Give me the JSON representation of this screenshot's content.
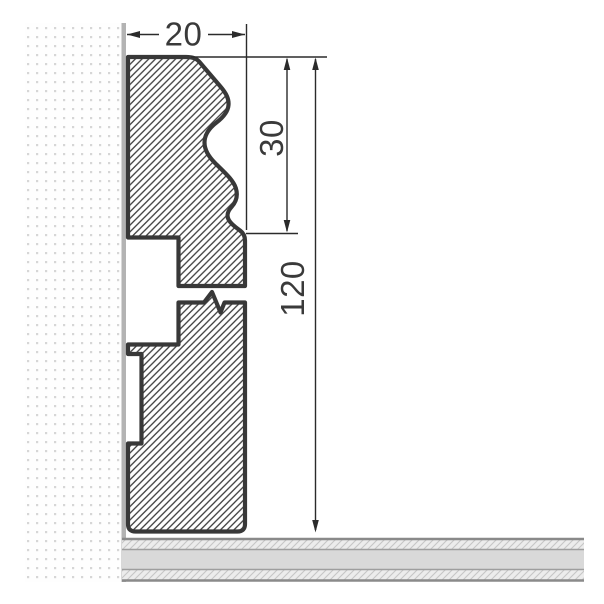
{
  "drawing": {
    "dimensions": {
      "width_label": "20",
      "ogee_height_label": "30",
      "total_height_label": "120"
    },
    "colors": {
      "outline": "#383838",
      "hatch_line": "#3d3d3d",
      "dimension_line": "#2b2b2b",
      "label_text": "#3a3a3a",
      "wall_edge": "#b3b3b3",
      "wall_dot": "#d6d6d6",
      "floor_core": "#d9d9d9",
      "floor_hatch_bg": "#ececec",
      "floor_hatch_line": "#c6c6c6",
      "floor_border": "#8a8a8a",
      "background": "#ffffff"
    }
  }
}
